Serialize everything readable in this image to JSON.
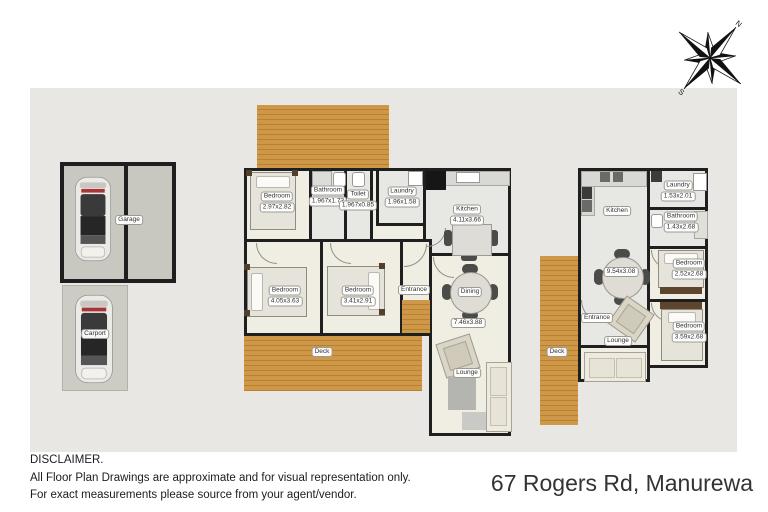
{
  "page": {
    "address": "67 Rogers Rd, Manurewa",
    "disclaimer_title": "DISCLAIMER.",
    "disclaimer_line1": "All Floor Plan Drawings are approximate and for visual representation only.",
    "disclaimer_line2": "For exact measurements please source from your agent/vendor."
  },
  "compass": {
    "north": "N",
    "south": "S"
  },
  "colors": {
    "panel": "#e9e7e3",
    "deck_wood": "#cf9848",
    "wall": "#1f1f1f",
    "floor_cream": "#f0eee2",
    "floor_gray": "#e7e7e3"
  },
  "outbuildings": {
    "garage": {
      "label": "Garage"
    },
    "carport": {
      "label": "Carport"
    }
  },
  "main_house": {
    "bedroom1": {
      "name": "Bedroom",
      "dims": "2.97x2.82"
    },
    "bathroom": {
      "name": "Bathroom",
      "dims": "1.967x1.73"
    },
    "toilet": {
      "name": "Toilet",
      "dims": "1.967x0.85"
    },
    "laundry": {
      "name": "Laundry",
      "dims": "1.96x1.58"
    },
    "kitchen": {
      "name": "Kitchen",
      "dims": "4.11x3.66"
    },
    "bedroom2": {
      "name": "Bedroom",
      "dims": "4.05x3.63"
    },
    "bedroom3": {
      "name": "Bedroom",
      "dims": "3.41x2.91"
    },
    "entrance": {
      "name": "Entrance"
    },
    "dining": {
      "name": "Dining",
      "dims": "7.46x3.88"
    },
    "lounge": {
      "name": "Lounge"
    },
    "deck": {
      "name": "Deck"
    }
  },
  "minor_dwelling": {
    "kitchen": {
      "name": "Kitchen",
      "dims": "9.54x3.08"
    },
    "laundry": {
      "name": "Laundry",
      "dims": "1.53x2.01"
    },
    "bathroom": {
      "name": "Bathroom",
      "dims": "1.43x2.68"
    },
    "bedroom1": {
      "name": "Bedroom",
      "dims": "2.52x2.68"
    },
    "bedroom2": {
      "name": "Bedroom",
      "dims": "3.59x2.68"
    },
    "entrance": {
      "name": "Entrance"
    },
    "lounge": {
      "name": "Lounge"
    },
    "deck": {
      "name": "Deck"
    }
  }
}
